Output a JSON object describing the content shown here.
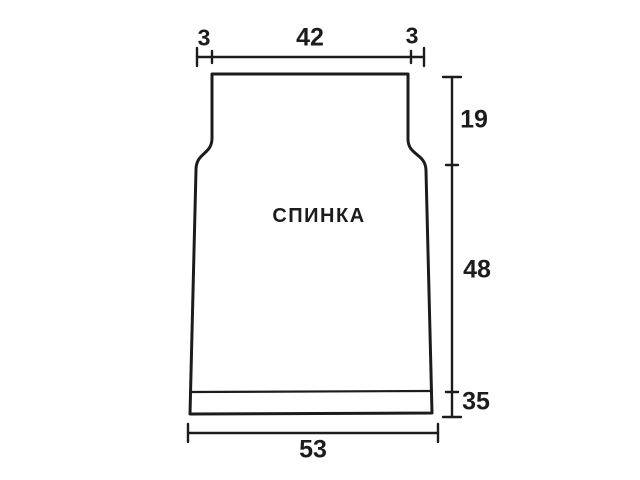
{
  "diagram": {
    "piece_label": "СПИНКА",
    "dimensions": {
      "top_left": "3",
      "top_center": "42",
      "top_right": "3",
      "right_upper": "19",
      "right_middle": "48",
      "right_lower": "35",
      "bottom": "53"
    },
    "colors": {
      "line": "#1c1c1c",
      "background": "#ffffff"
    }
  }
}
